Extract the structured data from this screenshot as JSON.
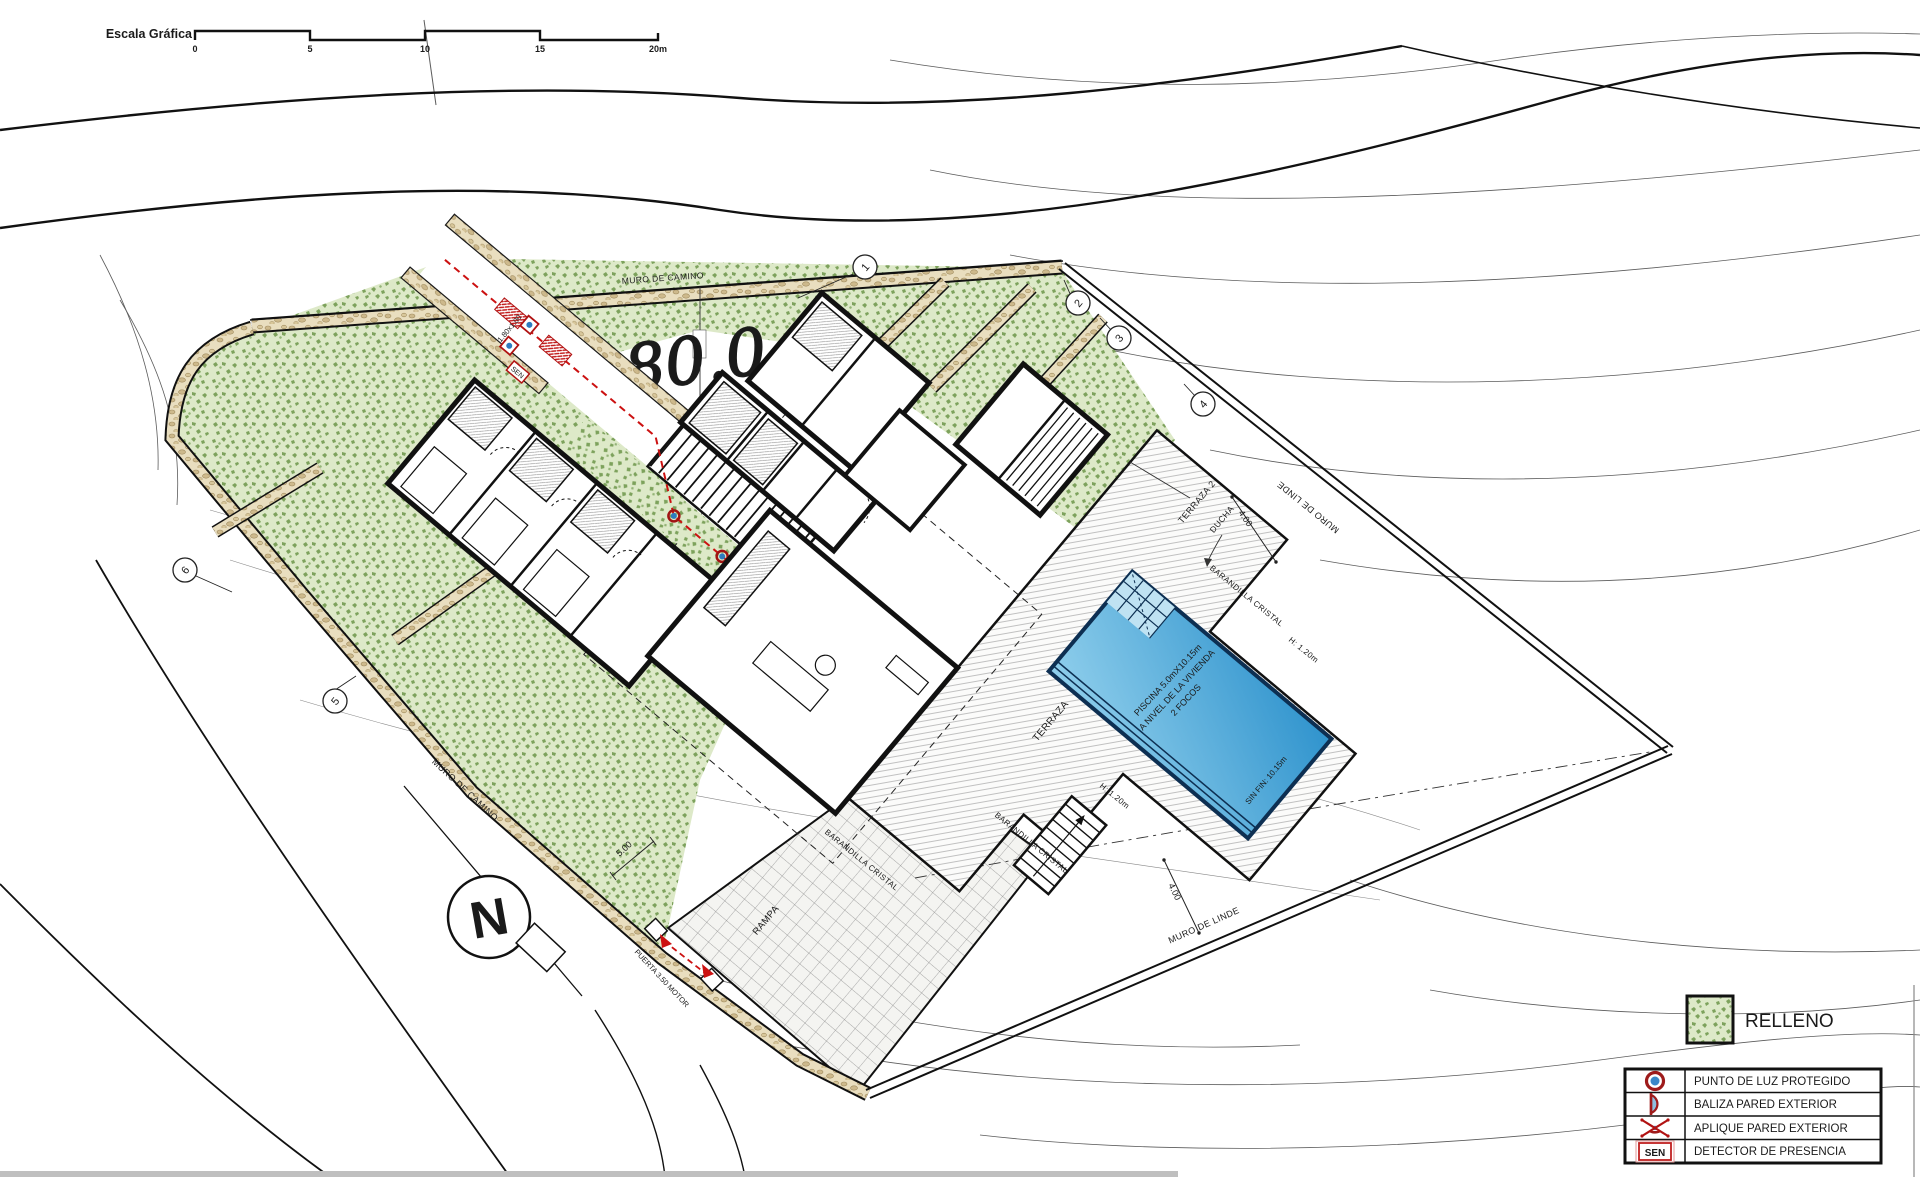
{
  "scale_bar": {
    "label": "Escala Gráfica",
    "ticks": [
      "0",
      "5",
      "10",
      "15",
      "20m"
    ]
  },
  "plan": {
    "elevation": "280.0",
    "labels": {
      "muro_de_camino": "MURO DE CAMINO",
      "muro_de_linde": "MURO DE LINDE",
      "terraza": "TERRAZA",
      "terraza2": "TERRAZA 2",
      "ducha": "DUCHA",
      "rampa": "RAMPA",
      "barandilla": "BARANDILLA CRISTAL",
      "altura_barandilla": "H: 1.20m",
      "dim_4a": "4.00",
      "dim_4b": "4.00",
      "dim_5": "5.00",
      "gate_size": "1.80x1.00",
      "puerta_motor": "PUERTA 3.50 MOTOR",
      "sen": "SEN"
    },
    "pool": {
      "line1": "PISCINA 5.0mX10.15m",
      "line2": "A NIVEL DE LA VIVIENDA",
      "line3": "2 FOCOS",
      "edge_label": "SIN FIN: 10.15m"
    },
    "markers": [
      "1",
      "2",
      "3",
      "4",
      "5",
      "6"
    ],
    "north": "N"
  },
  "legend": {
    "relleno": "RELLENO",
    "items": [
      {
        "label": "PUNTO DE LUZ PROTEGIDO"
      },
      {
        "label": "BALIZA PARED EXTERIOR"
      },
      {
        "label": "APLIQUE PARED EXTERIOR"
      },
      {
        "label": "DETECTOR DE PRESENCIA"
      }
    ],
    "sen": "SEN"
  },
  "colors": {
    "relleno_green": "#7da25c",
    "wall_tan": "#cdb98c",
    "pool_blue": "#2f93cd",
    "accent_red": "#b11212"
  }
}
